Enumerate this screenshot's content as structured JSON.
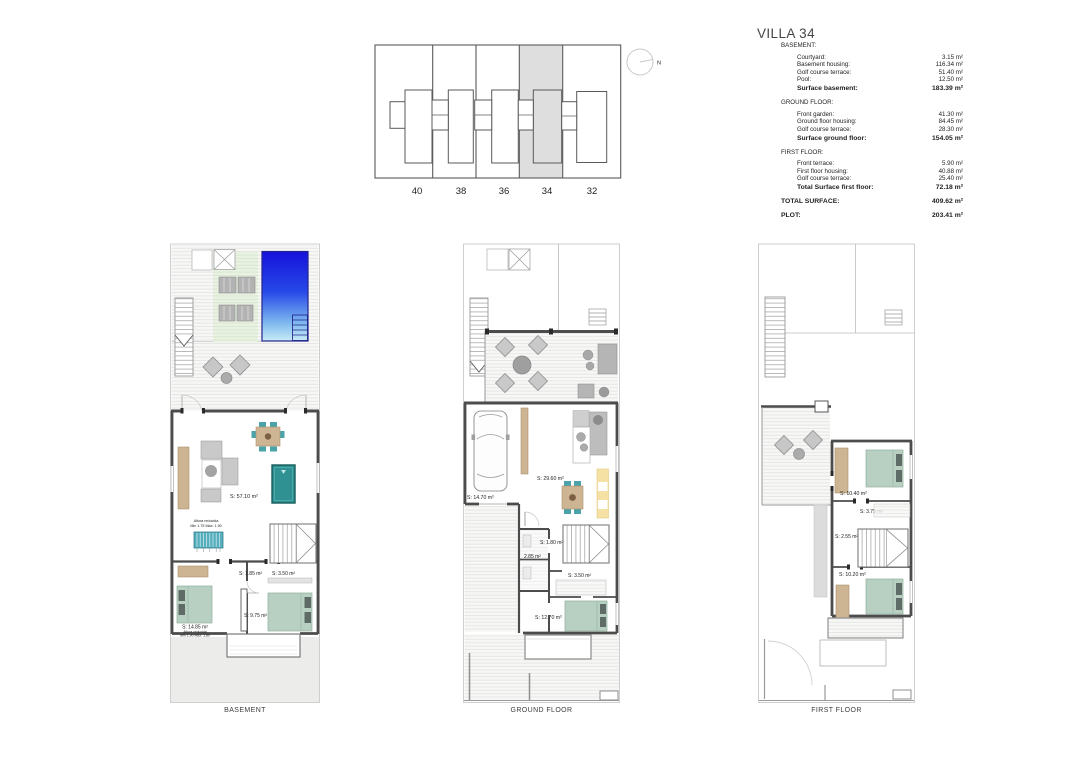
{
  "title": "VILLA 34",
  "summary": {
    "sections": [
      {
        "header": "BASEMENT:",
        "rows": [
          {
            "label": "Courtyard:",
            "value": "3.15 m²"
          },
          {
            "label": "Basement housing:",
            "value": "116.34 m²"
          },
          {
            "label": "Golf course terrace:",
            "value": "51.40 m²"
          },
          {
            "label": "Pool:",
            "value": "12.50 m²"
          }
        ],
        "total": {
          "label": "Surface basement:",
          "value": "183.39 m²"
        }
      },
      {
        "header": "GROUND FLOOR:",
        "rows": [
          {
            "label": "Front garden:",
            "value": "41.30 m²"
          },
          {
            "label": "Ground floor housing:",
            "value": "84.45 m²"
          },
          {
            "label": "Golf course terrace:",
            "value": "28.30 m²"
          }
        ],
        "total": {
          "label": "Surface ground floor:",
          "value": "154.05 m²"
        }
      },
      {
        "header": "FIRST FLOOR:",
        "rows": [
          {
            "label": "Front terrace:",
            "value": "5.90 m²"
          },
          {
            "label": "First floor housing:",
            "value": "40.88 m²"
          },
          {
            "label": "Golf course terrace:",
            "value": "25.40 m²"
          }
        ],
        "total": {
          "label": "Total Surface first floor:",
          "value": "72.18 m²"
        }
      }
    ],
    "grand_total": {
      "label": "TOTAL SURFACE:",
      "value": "409.62 m²"
    },
    "plot": {
      "label": "PLOT:",
      "value": "203.41 m²"
    }
  },
  "siteplan": {
    "units": [
      "40",
      "38",
      "36",
      "34",
      "32"
    ],
    "highlighted_unit": "34",
    "north_label": "N"
  },
  "plans": {
    "basement": {
      "caption": "BASEMENT",
      "labels": {
        "main": "S: 57.10 m²",
        "altura_upper_1": "Altura reducida",
        "altura_upper_2": "Min 1.75 Max: 1.90",
        "store": "S: 1.85 m²",
        "bath": "S: 3.50 m²",
        "bed_right": "S: 9.75 m²",
        "bed_left": "S: 14.85 m²",
        "altura_lower_1": "Altura reducida",
        "altura_lower_2": "Min 1.90 Max: 1.80"
      }
    },
    "ground": {
      "caption": "GROUND FLOOR",
      "labels": {
        "garage": "S: 14.70 m²",
        "living": "S: 29.60 m²",
        "hall": "S: 1.80 m²",
        "wc": "2.85 m²",
        "bath": "S: 3.50 m²",
        "bed": "S: 12.70 m²"
      }
    },
    "first": {
      "caption": "FIRST FLOOR",
      "labels": {
        "bed_top": "S: 10.40 m²",
        "bath": "S: 3.75 m²",
        "hall": "S: 2.55 m²",
        "bed_bottom": "S: 10.20 m²"
      }
    }
  },
  "colors": {
    "pool_top": "#1512da",
    "pool_bottom": "#c9ecf6",
    "deck_green": "#e9f1e3",
    "furniture_teal": "#4aa3a8",
    "pool_table_teal": "#2f9191",
    "wood_tan": "#cdb493",
    "bed_green": "#b7d0c2",
    "cabinet_yellow": "#f5e1a4",
    "highlight_gray": "#dedede",
    "wall_gray": "#4c4c4c"
  }
}
